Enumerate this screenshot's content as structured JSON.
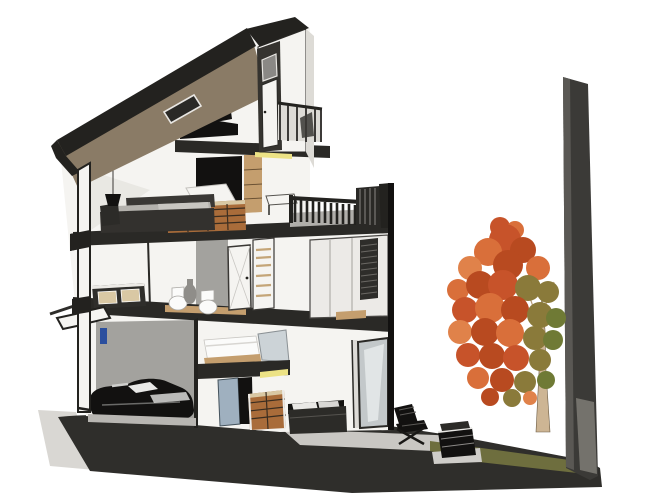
{
  "scene": {
    "title": "3D cutaway section perspective of a modern three-storey townhouse with roof terrace, garage, garden patio, autumn tree and boundary wall",
    "objects": [
      {
        "name": "shed-roof",
        "desc": "mono-pitched roof, brown soffit, dark fascia"
      },
      {
        "name": "skylight",
        "desc": "dark rooflight in roof plane"
      },
      {
        "name": "stair-tower",
        "desc": "rooftop access tower with door"
      },
      {
        "name": "balcony",
        "desc": "glazed balcony beside tower"
      },
      {
        "name": "roof-terrace",
        "desc": "deck with slatted railing and white table"
      },
      {
        "name": "mezzanine-desk",
        "desc": "black desk and chair on mezzanine slab"
      },
      {
        "name": "living-room",
        "desc": "sofa, pendant lamp, kitchen counter, crate shelving"
      },
      {
        "name": "bathroom",
        "desc": "two white toilets, vase, timber floor strip, doors, wardrobe"
      },
      {
        "name": "dresser",
        "desc": "drawer unit on bathroom level"
      },
      {
        "name": "garage",
        "desc": "black car against gray wall, blue door frame"
      },
      {
        "name": "bedroom",
        "desc": "white bed on cantilevered slab with glass headboard"
      },
      {
        "name": "storage-crates",
        "desc": "stacked timber crates"
      },
      {
        "name": "lounge",
        "desc": "ground floor daybed sofa facing patio"
      },
      {
        "name": "patio",
        "desc": "barcelona-style chair and low media bench on paving"
      },
      {
        "name": "garden-tree",
        "desc": "autumn tree with orange-red foliage"
      },
      {
        "name": "boundary-wall",
        "desc": "tall dark party wall at right"
      },
      {
        "name": "ground",
        "desc": "dark sloping ground mass with grass strip and sidewalk"
      }
    ]
  },
  "palette": {
    "bg": "#ffffff",
    "ink": "#23221f",
    "slab": "#2a2926",
    "wall-white": "#f5f4f1",
    "wall-shade": "#dddbd6",
    "gray-wall": "#a3a29e",
    "ground": "#2f2e2b",
    "grass": "#6e6e3e",
    "patio": "#c9c7c3",
    "sidewalk": "#d9d7d3",
    "party-wall": "#3b3a37",
    "party-wall-edge": "#5a5854",
    "party-wall-base": "#74726c",
    "roof-brown": "#8a7b66",
    "wood": "#c49e6e",
    "wood-light": "#d9c8a4",
    "crate": "#a96c3a",
    "accent-yellow": "#ece285",
    "accent-blue": "#2b4f9e",
    "glass": "#ccd3d7",
    "glass-dark": "#c3c8ca",
    "cushion": "#b4b2ad",
    "fixture-white": "#fbfbfa",
    "object-black": "#121110",
    "trunk": "#cdb594",
    "leaf-1": "#c7532a",
    "leaf-2": "#d96f3a",
    "leaf-3": "#b84a20",
    "leaf-4": "#e0824a",
    "leaf-olive": "#8a7a3a",
    "leaf-green": "#6f7a35",
    "line-light": "#8a8884"
  }
}
